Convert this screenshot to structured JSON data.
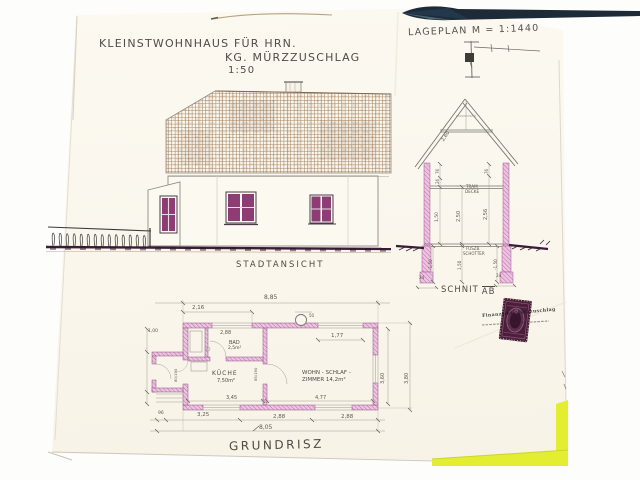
{
  "title": {
    "line1": "KLEINSTWOHNHAUS  FÜR  HRN.",
    "line2": "KG. MÜRZZUSCHLAG",
    "scale": "1:50"
  },
  "siteplan": {
    "label": "LAGEPLAN   M = 1:1440"
  },
  "elevation": {
    "label": "STADTANSICHT"
  },
  "section": {
    "label_text": "SCHNIT",
    "label_ab": "AB",
    "d260": "2,60",
    "tram1": "TRAM",
    "tram2": "DECKE",
    "d76l": "76",
    "d26": "26",
    "d150": "1,50",
    "d250": "2,50",
    "d76r": "76",
    "d256": "2,56",
    "fusz1": "FUSZB.",
    "fusz2": "SCHOTTER",
    "f150l": "-1,50",
    "f150m": "1,50",
    "f150r": "-1,50",
    "b24l": "24",
    "b24r": "24"
  },
  "plan": {
    "label": "GRUNDRISZ",
    "kueche": "KÜCHE",
    "kueche_area": "7,50m²",
    "bad": "BAD",
    "bad_area": "2,5m²",
    "wohn1": "WOHN - SCHLAF -",
    "wohn2": "ZIMMER  14,2m²",
    "d_total_top": "8,85",
    "d216": "2,16",
    "d288top": "2,88",
    "d177": "1,77",
    "d50": "50",
    "d345": "3,45",
    "d477": "4,77",
    "d96": "96",
    "d325": "3,25",
    "d288a": "2,88",
    "d288b": "2,88",
    "d805": "8,05",
    "d360": "3,60",
    "d380": "3,80",
    "d100": "1,00",
    "door1": "85/190",
    "door2": "80/190"
  },
  "stamp": {
    "overprint": "Finanzamt Mürzzuschlag"
  },
  "colors": {
    "paper": "#fbf8f0",
    "ink": "#5d584f",
    "window_magenta": "#8d3d74",
    "wall_pink": "#ecc4e0",
    "hatch_pink": "#b05a9b",
    "roof_tan": "#a5825f",
    "ground_plum": "#3c1c39",
    "fold_navy": "#1d2b39",
    "corner_yellow": "#e3ee33",
    "stamp_maroon": "#4b1e3a"
  }
}
